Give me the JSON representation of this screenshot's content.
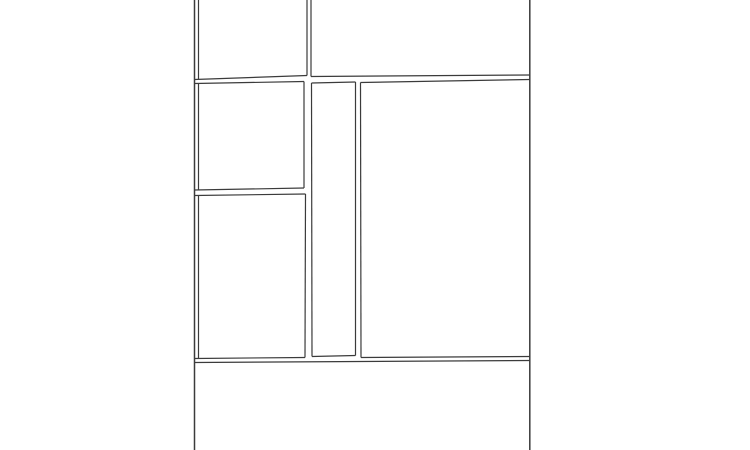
{
  "canvas": {
    "width": 750,
    "height": 450,
    "background_color": "#ffffff",
    "line_color": "#3b3b3b",
    "line_width": 1.2,
    "border_line_width": 1.5,
    "description": "Blank comic-page style panel layout: page bordered left and right, two top panels, middle row with two stacked left panels, a narrow vertical center panel and a large right panel, and an empty bottom section; horizontal gutters slightly slanted."
  },
  "drawing": {
    "segments": [
      {
        "name": "page-border-left",
        "x1": 194.5,
        "y1": 0,
        "x2": 194.5,
        "y2": 450,
        "kind": "border"
      },
      {
        "name": "page-border-right",
        "x1": 529.8,
        "y1": 0,
        "x2": 529.8,
        "y2": 450,
        "kind": "border"
      },
      {
        "name": "panel-a-left",
        "x1": 198.5,
        "y1": 0,
        "x2": 198.5,
        "y2": 79.5,
        "kind": "panel-edge"
      },
      {
        "name": "panel-a-right",
        "x1": 307,
        "y1": 0,
        "x2": 307,
        "y2": 75.5,
        "kind": "panel-edge"
      },
      {
        "name": "panel-a-bottom",
        "x1": 194.5,
        "y1": 79.5,
        "x2": 307,
        "y2": 75.5,
        "kind": "panel-edge"
      },
      {
        "name": "panel-b-left",
        "x1": 311,
        "y1": 0,
        "x2": 311,
        "y2": 76.5,
        "kind": "panel-edge"
      },
      {
        "name": "panel-b-bottom",
        "x1": 311,
        "y1": 76.5,
        "x2": 529.8,
        "y2": 75,
        "kind": "panel-edge"
      },
      {
        "name": "panel-c-top",
        "x1": 194.5,
        "y1": 83.5,
        "x2": 304,
        "y2": 81.5,
        "kind": "panel-edge"
      },
      {
        "name": "panel-c-left",
        "x1": 198.5,
        "y1": 83.5,
        "x2": 198.5,
        "y2": 190,
        "kind": "panel-edge"
      },
      {
        "name": "panel-c-right",
        "x1": 304,
        "y1": 81.5,
        "x2": 304,
        "y2": 188,
        "kind": "panel-edge"
      },
      {
        "name": "panel-c-bottom",
        "x1": 194.5,
        "y1": 190,
        "x2": 304,
        "y2": 188,
        "kind": "panel-edge"
      },
      {
        "name": "panel-d-top",
        "x1": 194.5,
        "y1": 195.5,
        "x2": 305.5,
        "y2": 194,
        "kind": "panel-edge"
      },
      {
        "name": "panel-d-left",
        "x1": 198.5,
        "y1": 195.5,
        "x2": 198.5,
        "y2": 358.5,
        "kind": "panel-edge"
      },
      {
        "name": "panel-d-right",
        "x1": 305.5,
        "y1": 194,
        "x2": 305,
        "y2": 357.5,
        "kind": "panel-edge"
      },
      {
        "name": "panel-d-bottom",
        "x1": 194.5,
        "y1": 358.5,
        "x2": 305,
        "y2": 357.5,
        "kind": "panel-edge"
      },
      {
        "name": "panel-e-top",
        "x1": 311.5,
        "y1": 83,
        "x2": 355.5,
        "y2": 82,
        "kind": "panel-edge"
      },
      {
        "name": "panel-e-left",
        "x1": 311.5,
        "y1": 83,
        "x2": 312,
        "y2": 356.5,
        "kind": "panel-edge"
      },
      {
        "name": "panel-e-right",
        "x1": 355.5,
        "y1": 82,
        "x2": 355.5,
        "y2": 355.5,
        "kind": "panel-edge"
      },
      {
        "name": "panel-e-bottom",
        "x1": 312,
        "y1": 356.5,
        "x2": 355.5,
        "y2": 355.5,
        "kind": "panel-edge"
      },
      {
        "name": "panel-f-top",
        "x1": 360.5,
        "y1": 82.5,
        "x2": 529.8,
        "y2": 79.5,
        "kind": "panel-edge"
      },
      {
        "name": "panel-f-left",
        "x1": 360.5,
        "y1": 82.5,
        "x2": 361,
        "y2": 357.5,
        "kind": "panel-edge"
      },
      {
        "name": "panel-f-bottom",
        "x1": 361,
        "y1": 357.5,
        "x2": 529.8,
        "y2": 356.5,
        "kind": "panel-edge"
      },
      {
        "name": "bottom-section-top",
        "x1": 194.5,
        "y1": 362.5,
        "x2": 529.8,
        "y2": 360.5,
        "kind": "panel-edge"
      }
    ]
  }
}
